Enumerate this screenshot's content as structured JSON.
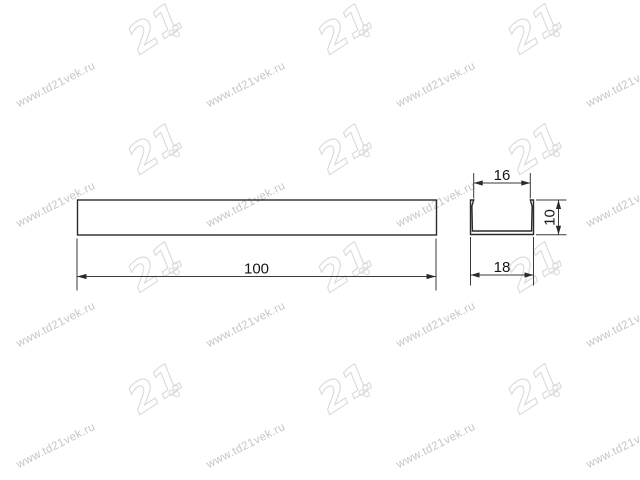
{
  "watermark": {
    "text": "www.td21vek.ru",
    "logo_text": "21",
    "logo_badge": "СОЮЗ",
    "text_color": "#c6c6c6",
    "logo_color": "#dadada"
  },
  "drawing": {
    "type": "technical-drawing",
    "part": "U-channel profile, front view and cross-section",
    "line_color": "#2b2b2b",
    "dim_color": "#3a3a3a",
    "text_color": "#161616",
    "front_view": {
      "length_label": "100"
    },
    "section_view": {
      "inner_width_label": "16",
      "outer_width_label": "18",
      "height_label": "10"
    }
  }
}
